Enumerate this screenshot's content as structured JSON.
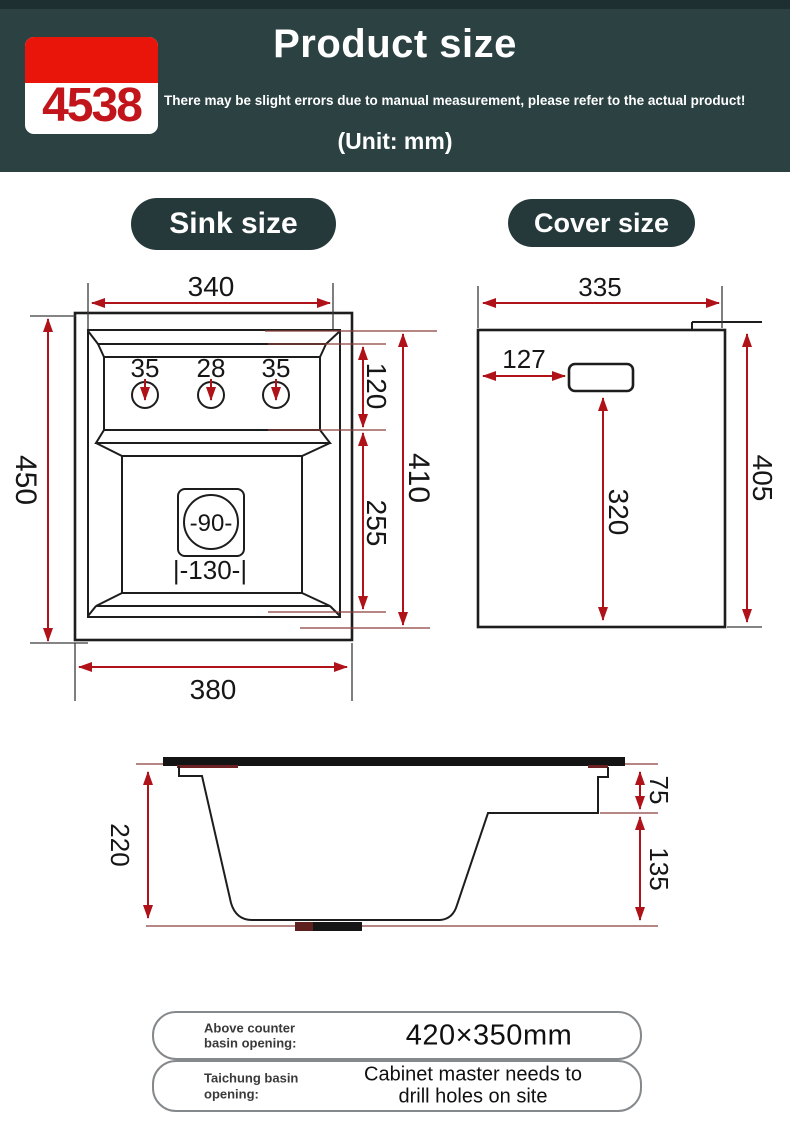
{
  "header": {
    "badge_number": "4538",
    "title": "Product size",
    "subtitle": "There may be slight errors due to manual measurement, please refer to the actual product!",
    "unit_note": "(Unit: mm)"
  },
  "section_labels": {
    "sink": "Sink size",
    "cover": "Cover size"
  },
  "sink_view": {
    "top_inner_width": "340",
    "hole_diameters": [
      "35",
      "28",
      "35"
    ],
    "deck_depth": "120",
    "basin_depth": "255",
    "inner_height": "410",
    "overall_height": "450",
    "overall_width": "380",
    "drain_diameter": "-90-",
    "drain_spacing": "|-130-|"
  },
  "cover_view": {
    "width": "335",
    "handle_inset": "127",
    "handle_to_bottom": "320",
    "height": "405"
  },
  "side_view": {
    "overall_depth": "220",
    "rim_step": "75",
    "lower_step": "135"
  },
  "notes": [
    {
      "label": [
        "Above counter",
        "basin opening:"
      ],
      "value": [
        "420×350mm"
      ]
    },
    {
      "label": [
        "Taichung basin",
        "opening:"
      ],
      "value": [
        "Cabinet master needs to",
        "drill holes on site"
      ]
    }
  ],
  "colors": {
    "header_bg": "#2b4142",
    "badge_red": "#e9140a",
    "pill_bg": "#26393a",
    "dimension_red": "#b01219",
    "line_black": "#1d1d1d"
  }
}
